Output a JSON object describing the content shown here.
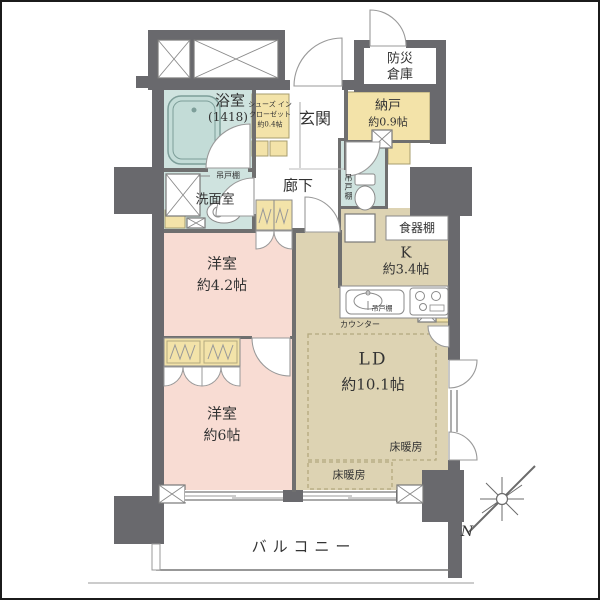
{
  "colors": {
    "wall": "#69696d",
    "wet_rooms": "#cfe3df",
    "bedrooms": "#f8dcd3",
    "living": "#ddd3b3",
    "storage": "#f3e3a9"
  },
  "rooms": {
    "bousai_soko": {
      "line1": "防災",
      "line2": "倉庫"
    },
    "bathroom": {
      "name": "浴室",
      "size": "(1418)"
    },
    "shoes_in_closet": {
      "line1": "シューズ イン",
      "line2": "クローゼット",
      "line3": "約0.4帖"
    },
    "entrance": {
      "name": "玄関"
    },
    "storage_nando": {
      "name": "納戸",
      "size": "約0.9帖"
    },
    "washroom": {
      "name": "洗面室",
      "hanging_cabinet": "吊戸棚"
    },
    "hallway": {
      "name": "廊下"
    },
    "toilet": {
      "hanging_cabinet": "吊戸棚"
    },
    "kitchen": {
      "name": "K",
      "size": "約3.4帖",
      "cupboard": "食器棚",
      "hanging_cabinet": "吊戸棚",
      "counter": "カウンター"
    },
    "western_room_42": {
      "name": "洋室",
      "size": "約4.2帖"
    },
    "western_room_6": {
      "name": "洋室",
      "size": "約6帖"
    },
    "living_dining": {
      "name": "LD",
      "size": "約10.1帖",
      "floor_heating": "床暖房"
    },
    "balcony": {
      "name": "バルコニー"
    }
  },
  "compass": {
    "north": "N"
  }
}
